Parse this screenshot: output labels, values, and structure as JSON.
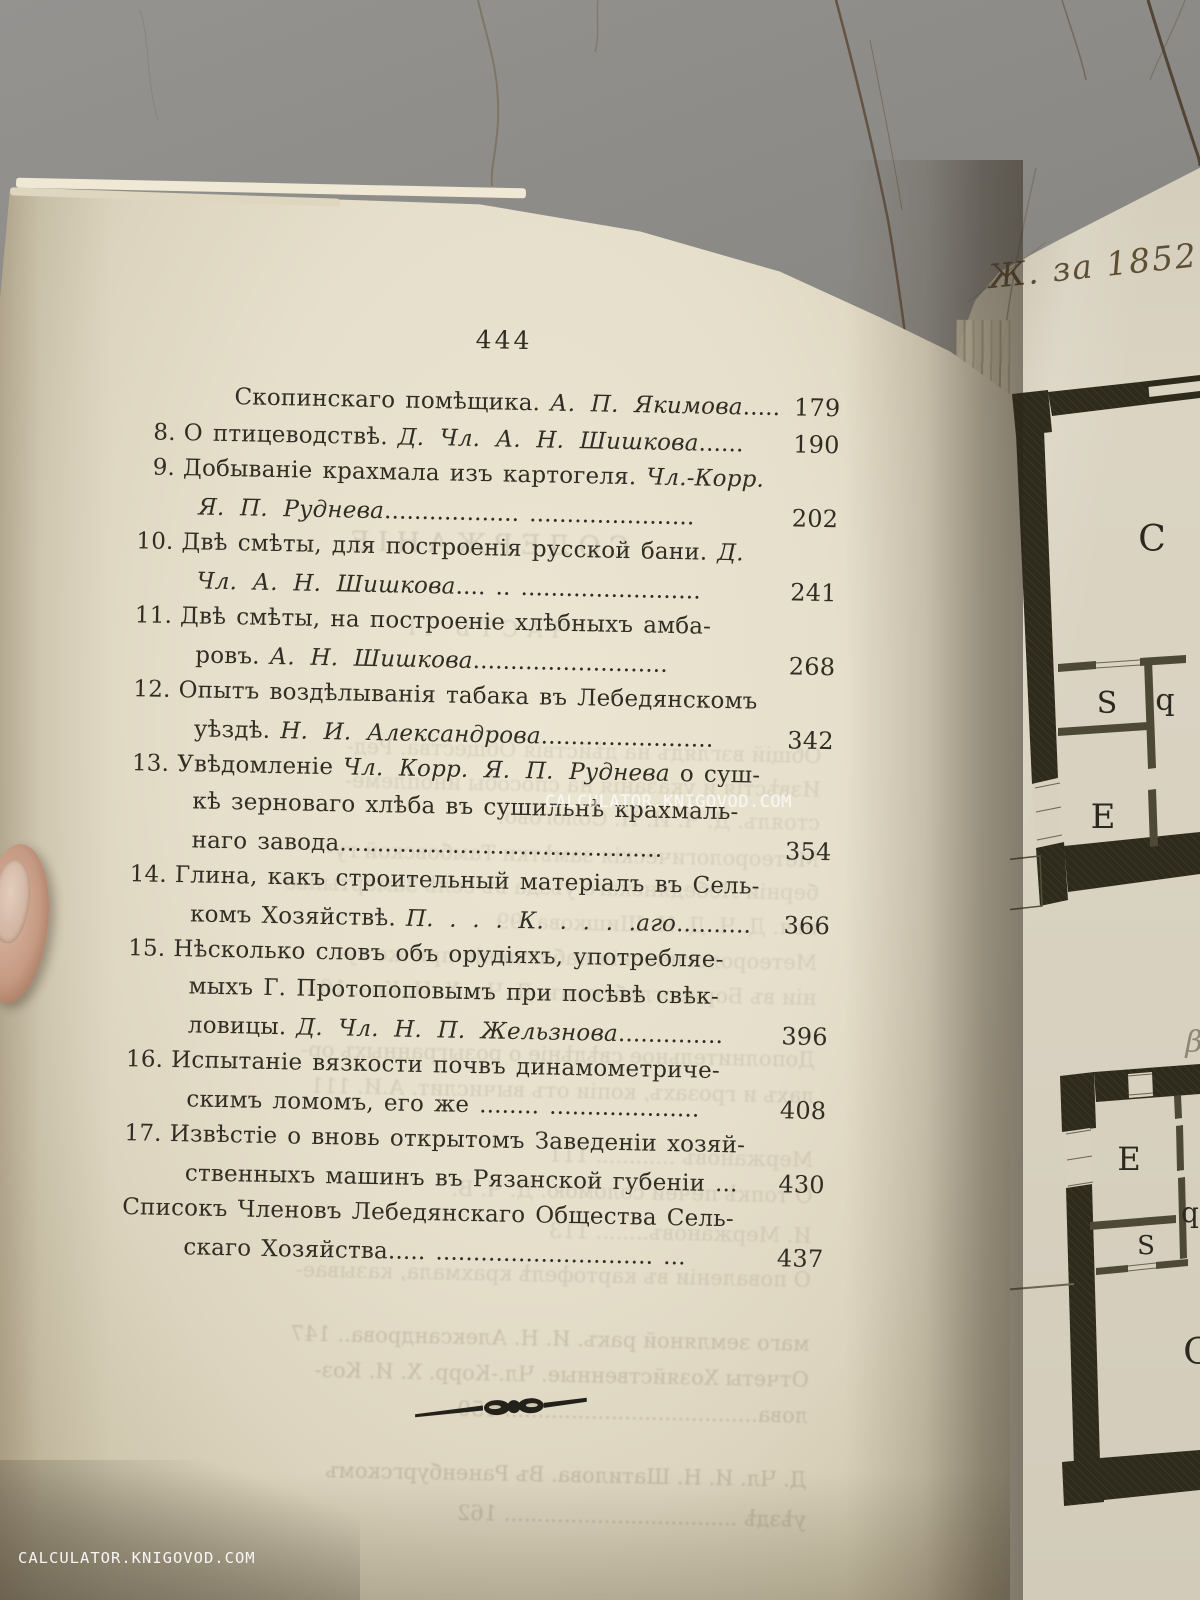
{
  "page_number": "444",
  "toc": {
    "rows": [
      {
        "type": "cont2",
        "num": "",
        "segs": [
          {
            "t": "Скопинскаго помѣщика. ",
            "i": false
          },
          {
            "t": "А. П. Якимова",
            "i": true
          },
          {
            "t": "......",
            "i": false
          }
        ],
        "page": "179"
      },
      {
        "type": "num",
        "num": "8.",
        "segs": [
          {
            "t": "О птицеводствѣ. ",
            "i": false
          },
          {
            "t": "Д. Чл. А. Н. Шишкова",
            "i": true
          },
          {
            "t": "......",
            "i": false
          }
        ],
        "page": "190"
      },
      {
        "type": "num",
        "num": "9.",
        "segs": [
          {
            "t": "Добываніе крахмала изъ картогеля. ",
            "i": false
          },
          {
            "t": "Чл.-Корр.",
            "i": true
          }
        ],
        "page": ""
      },
      {
        "type": "cont",
        "num": "",
        "segs": [
          {
            "t": "Я. П. Руднева",
            "i": true
          },
          {
            "t": ".................. ......................",
            "i": false
          }
        ],
        "page": "202"
      },
      {
        "type": "num",
        "num": "10.",
        "segs": [
          {
            "t": "Двѣ смѣты, для построенія русской бани. ",
            "i": false
          },
          {
            "t": "Д.",
            "i": true
          }
        ],
        "page": ""
      },
      {
        "type": "cont",
        "num": "",
        "segs": [
          {
            "t": "Чл. А. Н. Шишкова",
            "i": true
          },
          {
            "t": ".... .. ........................",
            "i": false
          }
        ],
        "page": "241"
      },
      {
        "type": "num",
        "num": "11.",
        "segs": [
          {
            "t": "Двѣ смѣты, на построеніе хлѣбныхъ амба-",
            "i": false
          }
        ],
        "page": ""
      },
      {
        "type": "cont",
        "num": "",
        "segs": [
          {
            "t": "ровъ. ",
            "i": false
          },
          {
            "t": "А. Н. Шишкова",
            "i": true
          },
          {
            "t": "..........................",
            "i": false
          }
        ],
        "page": "268"
      },
      {
        "type": "num",
        "num": "12.",
        "segs": [
          {
            "t": "Опытъ воздѣлыванія табака въ Лебедянскомъ",
            "i": false
          }
        ],
        "page": ""
      },
      {
        "type": "cont",
        "num": "",
        "segs": [
          {
            "t": "уѣздѣ. ",
            "i": false
          },
          {
            "t": "Н. И. Александрова",
            "i": true
          },
          {
            "t": ".......................",
            "i": false
          }
        ],
        "page": "342"
      },
      {
        "type": "num",
        "num": "13.",
        "segs": [
          {
            "t": "Увѣдомленіе ",
            "i": false
          },
          {
            "t": "Чл. Корр. Я. П. Руднева",
            "i": true
          },
          {
            "t": " о суш-",
            "i": false
          }
        ],
        "page": ""
      },
      {
        "type": "cont",
        "num": "",
        "segs": [
          {
            "t": "кѣ зерноваго хлѣба въ сушильнѣ крахмаль-",
            "i": false
          }
        ],
        "page": ""
      },
      {
        "type": "cont",
        "num": "",
        "segs": [
          {
            "t": "наго завода",
            "i": false
          },
          {
            "t": "...........................................",
            "i": false
          }
        ],
        "page": "354"
      },
      {
        "type": "num",
        "num": "14.",
        "segs": [
          {
            "t": "Глина, какъ строительный матеріалъ въ Сель-",
            "i": false
          }
        ],
        "page": ""
      },
      {
        "type": "cont",
        "num": "",
        "segs": [
          {
            "t": "комъ Хозяйствѣ. ",
            "i": false
          },
          {
            "t": "П. . . . К. . . . .аго",
            "i": true
          },
          {
            "t": "..........",
            "i": false
          }
        ],
        "page": "366"
      },
      {
        "type": "num",
        "num": "15.",
        "segs": [
          {
            "t": "Нѣсколько словъ объ орудіяхъ, употребляе-",
            "i": false
          }
        ],
        "page": ""
      },
      {
        "type": "cont",
        "num": "",
        "segs": [
          {
            "t": "мыхъ Г. Протопоповымъ при посѣвѣ свѣк-",
            "i": false
          }
        ],
        "page": ""
      },
      {
        "type": "cont",
        "num": "",
        "segs": [
          {
            "t": "ловицы. ",
            "i": false
          },
          {
            "t": "Д. Чл. Н. П. Жельзнова",
            "i": true
          },
          {
            "t": "..............",
            "i": false
          }
        ],
        "page": "396"
      },
      {
        "type": "num",
        "num": "16.",
        "segs": [
          {
            "t": "Испытаніе вязкости почвъ динамометриче-",
            "i": false
          }
        ],
        "page": ""
      },
      {
        "type": "cont",
        "num": "",
        "segs": [
          {
            "t": "скимъ ломомъ, его же ",
            "i": false
          },
          {
            "t": "........ ....................",
            "i": false
          }
        ],
        "page": "408"
      },
      {
        "type": "num",
        "num": "17.",
        "segs": [
          {
            "t": "Извѣстіе о вновь открытомъ Заведеніи хозяй-",
            "i": false
          }
        ],
        "page": ""
      },
      {
        "type": "cont",
        "num": "",
        "segs": [
          {
            "t": "ственныхъ машинъ въ Рязанской губеніи ...",
            "i": false
          }
        ],
        "page": "430"
      },
      {
        "type": "flush",
        "num": "",
        "segs": [
          {
            "t": "Списокъ Членовъ Лебедянскаго Общества Сель-",
            "i": false
          }
        ],
        "page": ""
      },
      {
        "type": "cont",
        "num": "",
        "segs": [
          {
            "t": "скаго Хозяйства",
            "i": false
          },
          {
            "t": "..... ............................. ...",
            "i": false
          }
        ],
        "page": "437"
      }
    ]
  },
  "plate": {
    "inscription": "Ж. за 1852",
    "rooms": {
      "top_c": "C",
      "top_s": "S",
      "top_p": "q",
      "top_e": "E",
      "script": "β",
      "bot_e": "E",
      "bot_q": "q",
      "bot_s": "S",
      "bot_c": "C"
    }
  },
  "watermarks": {
    "center": "CALCULATOR.KNIGOVOD.COM",
    "bottom_left": "CALCULATOR.KNIGOVOD.COM"
  },
  "ghosts": [
    {
      "y": 540,
      "t": "СОДЕРЖАНІЕ",
      "s": 27,
      "o": 0.16,
      "c": true
    },
    {
      "y": 628,
      "t": "ЧАСТЬ II",
      "s": 22,
      "o": 0.13,
      "c": true
    },
    {
      "y": 748,
      "t": "Общій взглядъ на дѣйствія Общества. Ред-",
      "o": 0.12
    },
    {
      "y": 782,
      "t": "Извѣстія и указанія на способы иноплеме-",
      "o": 0.12
    },
    {
      "y": 815,
      "t": "стоялъ. Д. Ч. И. Н. Сологово.",
      "o": 0.12
    },
    {
      "y": 852,
      "t": "Метеорологическія замѣтки Тамбовской гу-",
      "o": 0.13
    },
    {
      "y": 885,
      "t": "берніи Лебедянскаго уѣзда въ селѣ Замартынье",
      "o": 0.12
    },
    {
      "y": 920,
      "t": "нья. Д. Ч. Д. И. Шишкова.  99",
      "o": 0.12
    },
    {
      "y": 955,
      "t": "Метеорологическія наблюденія при же гу-",
      "o": 0.13
    },
    {
      "y": 990,
      "t": "ніи въ Борисоглѣбскомъ. Д. Чл. Х. И. Коз.  104",
      "o": 0.13
    },
    {
      "y": 1052,
      "t": "Дополнительное свѣдѣніе о розыгранныхъ ор-",
      "o": 0.14
    },
    {
      "y": 1088,
      "t": "лахъ и грозахъ, копіи отъ вычислит. А.И.  111",
      "o": 0.14
    },
    {
      "y": 1152,
      "t": "Мержановъ ............  111",
      "o": 0.13
    },
    {
      "y": 1188,
      "t": "О топкѣ печей соломою. Д. Ч. В.",
      "o": 0.13
    },
    {
      "y": 1228,
      "t": "И. Мержановъ........  113",
      "o": 0.13
    },
    {
      "y": 1272,
      "t": "О поваленіи въ картофелѣ крахмала, казывае-",
      "o": 0.14
    },
    {
      "y": 1336,
      "t": "маго земляной ракъ. И. Н. Александрова..  147",
      "o": 0.2
    },
    {
      "y": 1372,
      "t": "Отчеты Хозяйственные. Чл.-Корр. Х. И. Коз-",
      "o": 0.2
    },
    {
      "y": 1408,
      "t": "лова......................................  150",
      "o": 0.2
    },
    {
      "y": 1472,
      "t": "Д. Чл. И. Н. Шатилова. Въ Раненбургскомъ",
      "o": 0.22
    },
    {
      "y": 1512,
      "t": "уѣздѣ ...................................  162",
      "o": 0.22
    }
  ],
  "colors": {
    "ink": "#322d24",
    "page": "#e6dfcb",
    "plate_paper": "#d8d1c0",
    "plan_wall": "#2e2b1d",
    "background_wall": "#7e7c76",
    "crack": "#54422e",
    "watermark": "#ffffff"
  }
}
